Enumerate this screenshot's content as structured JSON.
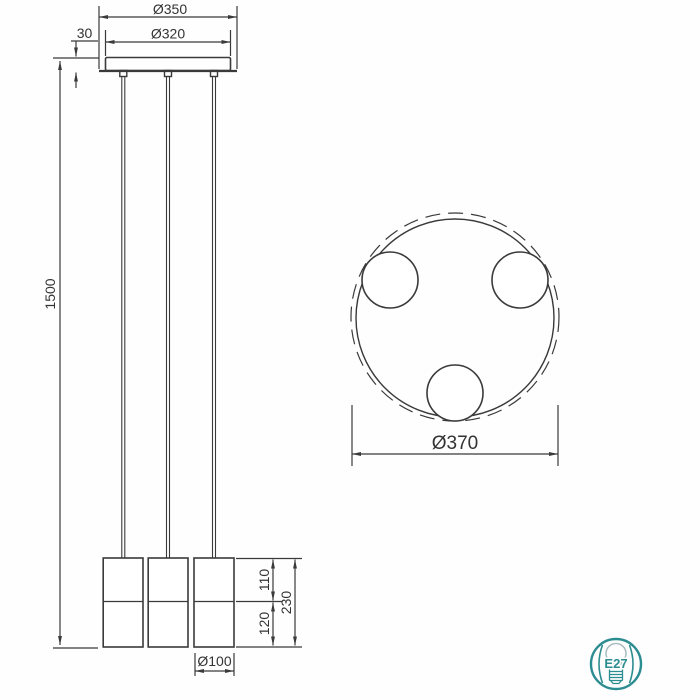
{
  "front_view": {
    "canopy_outer_diameter": "Ø350",
    "canopy_inner_diameter": "Ø320",
    "canopy_height": "30",
    "suspension_length": "1500",
    "shade_upper_height": "110",
    "shade_lower_height": "120",
    "shade_total_height": "230",
    "shade_diameter": "Ø100"
  },
  "top_view": {
    "overall_diameter": "Ø370"
  },
  "badge": {
    "socket_type": "E27"
  },
  "colors": {
    "line": "#3a3a3a",
    "badge_teal": "#2b8c91",
    "bulb_glass": "#a9bcc0",
    "background": "#fefefe"
  }
}
